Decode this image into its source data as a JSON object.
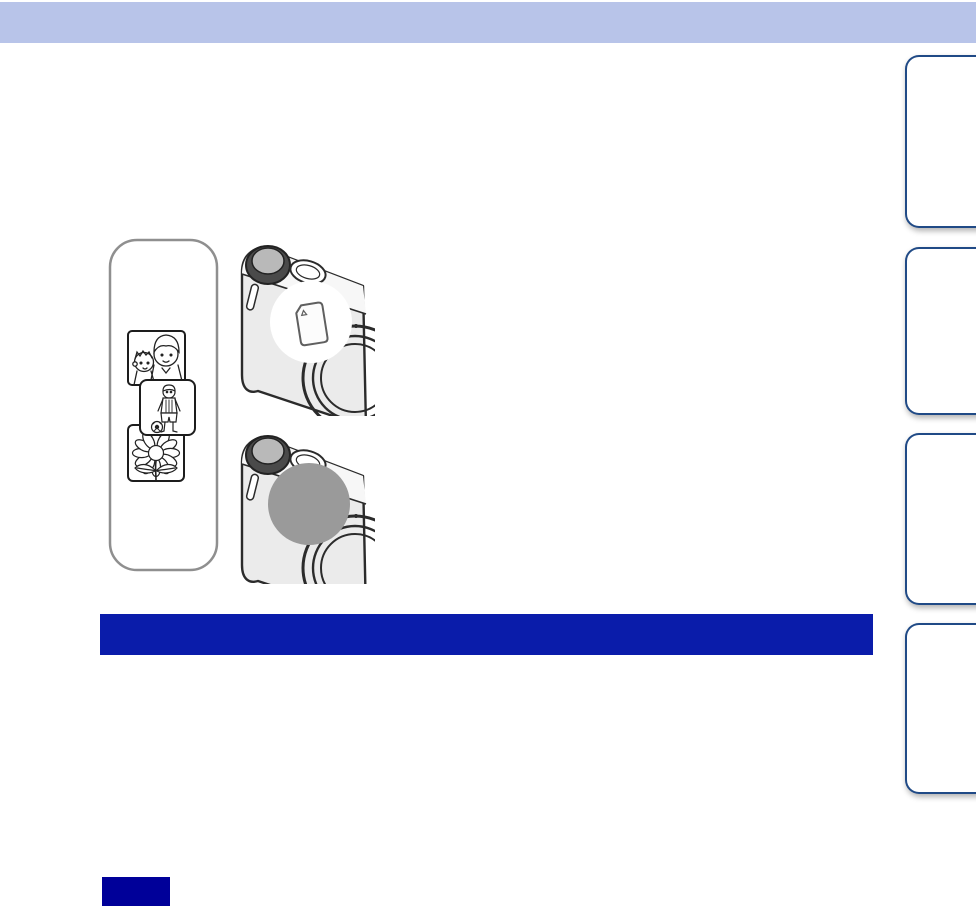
{
  "page": {
    "width": 976,
    "height": 906
  },
  "colors": {
    "page_bg": "#ffffff",
    "header_bar": "#b8c4e9",
    "section_bar": "#0a1caa",
    "footer_chip": "#000099",
    "tab_border": "#204a86",
    "tab_fill": "#ffffff",
    "line_art": "#2b2b2b",
    "camera_body": "#ebebeb",
    "camera_top_plate": "#f7f7f7",
    "camera_dial": "#4a4a4a",
    "camera_dial_top": "#b9b9b9",
    "memory_circle": "#9a9a9a",
    "strip_border": "#8f8f8f",
    "card_outline": "#5f5f5f"
  },
  "header": {
    "label": ""
  },
  "section_heading": {
    "label": ""
  },
  "footer_chip": {
    "label": ""
  },
  "nav_tabs": [
    {
      "label": ""
    },
    {
      "label": ""
    },
    {
      "label": ""
    },
    {
      "label": ""
    }
  ],
  "illustration": {
    "icons": [
      "photo-strip-icon",
      "kids-photo-icon",
      "boy-with-ball-photo-icon",
      "sunflower-photo-icon",
      "camera-back-icon",
      "memory-card-icon",
      "internal-memory-circle-icon"
    ]
  }
}
